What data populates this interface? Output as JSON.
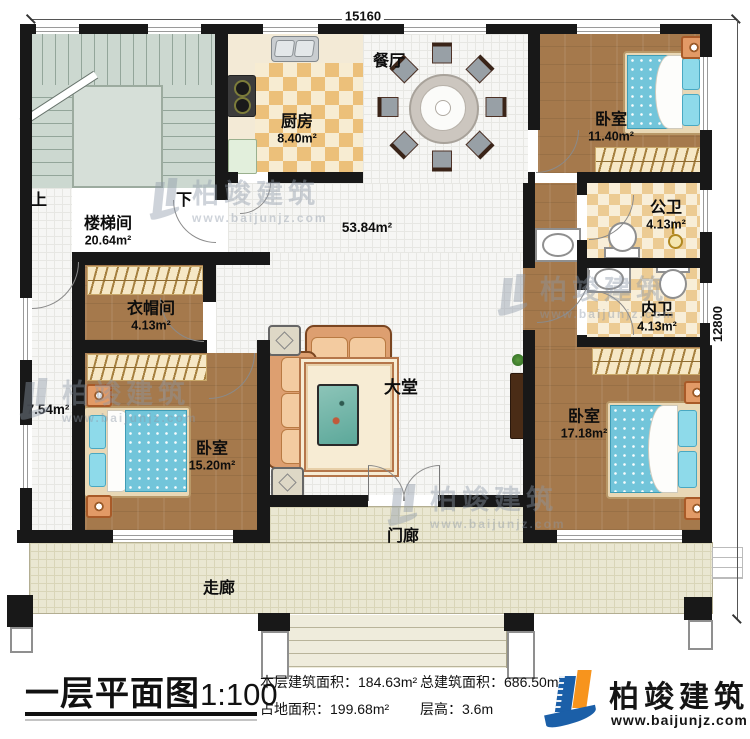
{
  "dimensions": {
    "top": "15160",
    "right": "12800"
  },
  "rooms": {
    "stairwell": {
      "name": "楼梯间",
      "area": "20.64m²"
    },
    "kitchen": {
      "name": "厨房",
      "area": "8.40m²"
    },
    "dining": {
      "name": "餐厅"
    },
    "open_area": {
      "area": "53.84m²"
    },
    "bedroom_ne": {
      "name": "卧室",
      "area": "11.40m²"
    },
    "bath_public": {
      "name": "公卫",
      "area": "4.13m²"
    },
    "bath_private": {
      "name": "内卫",
      "area": "4.13m²"
    },
    "cloakroom": {
      "name": "衣帽间",
      "area": "4.13m²"
    },
    "hallway_west": {
      "area": "7.54m²"
    },
    "lobby": {
      "name": "大堂"
    },
    "bedroom_sw": {
      "name": "卧室",
      "area": "15.20m²"
    },
    "bedroom_se": {
      "name": "卧室",
      "area": "17.18m²"
    },
    "porch": {
      "name": "门廊"
    },
    "corridor": {
      "name": "走廊"
    },
    "stairs": {
      "up": "上",
      "down": "下"
    }
  },
  "footer": {
    "title": "一层平面图",
    "scale": "1:100",
    "floor_area_label": "本层建筑面积：",
    "floor_area_value": "184.63m²",
    "land_area_label": "占地面积：",
    "land_area_value": "199.68m²",
    "total_area_label": "总建筑面积：",
    "total_area_value": "686.50m²",
    "height_label": "层高：",
    "height_value": "3.6m"
  },
  "branding": {
    "company": "柏竣建筑",
    "website": "www.baijunjz.com",
    "colors": {
      "blue": "#1b5fa8",
      "orange": "#f7941d"
    }
  }
}
